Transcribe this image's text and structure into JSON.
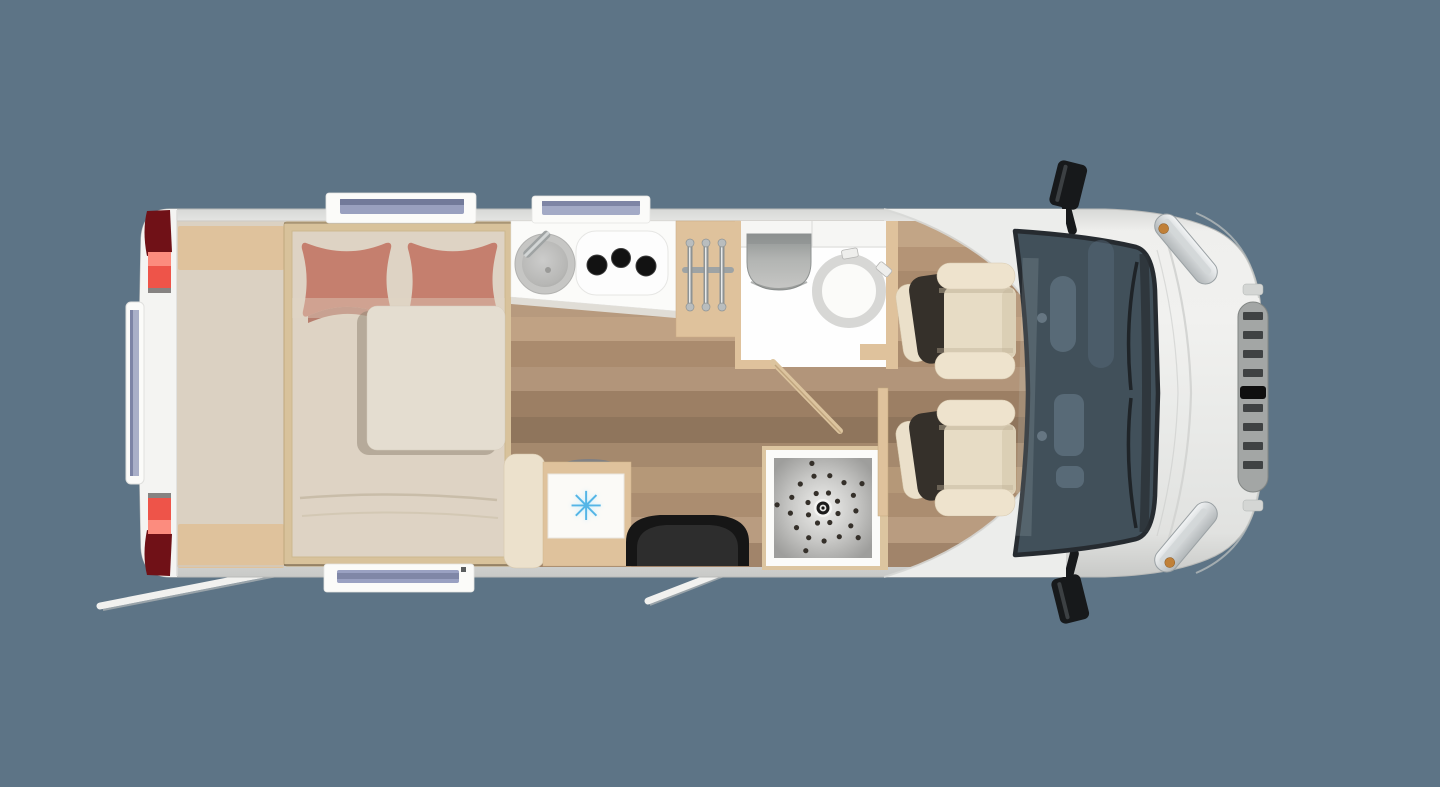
{
  "floorplan": {
    "view": "motorhome-top-down-floor-plan",
    "zones": [
      "rear-storage",
      "double-bed",
      "kitchen-counter",
      "towel-rail",
      "bathroom",
      "fridge",
      "entry-mat",
      "shower",
      "cab-seats",
      "cab-windshield",
      "front-grille"
    ],
    "colors": {
      "background": "#5d7486",
      "body": "#ecedeb",
      "wood_floor": "#ad8e72",
      "bed_area_floor": "#dbd1c2",
      "bed_frame": "#d8c29b",
      "mattress": "#ded3c4",
      "pillow": "#c57f6e",
      "duvet": "#e4ddd0",
      "counter_white": "#fbfbf9",
      "cabinetry_tan": "#dfc29c",
      "bathroom_white": "#fefefe",
      "entry_mat": "#161616",
      "seat_upholstery": "#e7dcc5",
      "seat_back": "#35302a",
      "windshield_glass": "#41505a",
      "taillight": "#ee5449",
      "snowflake": "#54b5e6"
    },
    "fridge": {
      "snowflake_glyph": "✳"
    },
    "shower": {
      "center_x": 823,
      "center_y": 508,
      "dot_radius": 2.6,
      "dot_color": "#35302a",
      "rings": [
        {
          "radius": 16,
          "count": 8,
          "phase": 20
        },
        {
          "radius": 33,
          "count": 13,
          "phase": 5
        },
        {
          "radius": 46,
          "count": 5,
          "phase": 40
        }
      ]
    }
  }
}
